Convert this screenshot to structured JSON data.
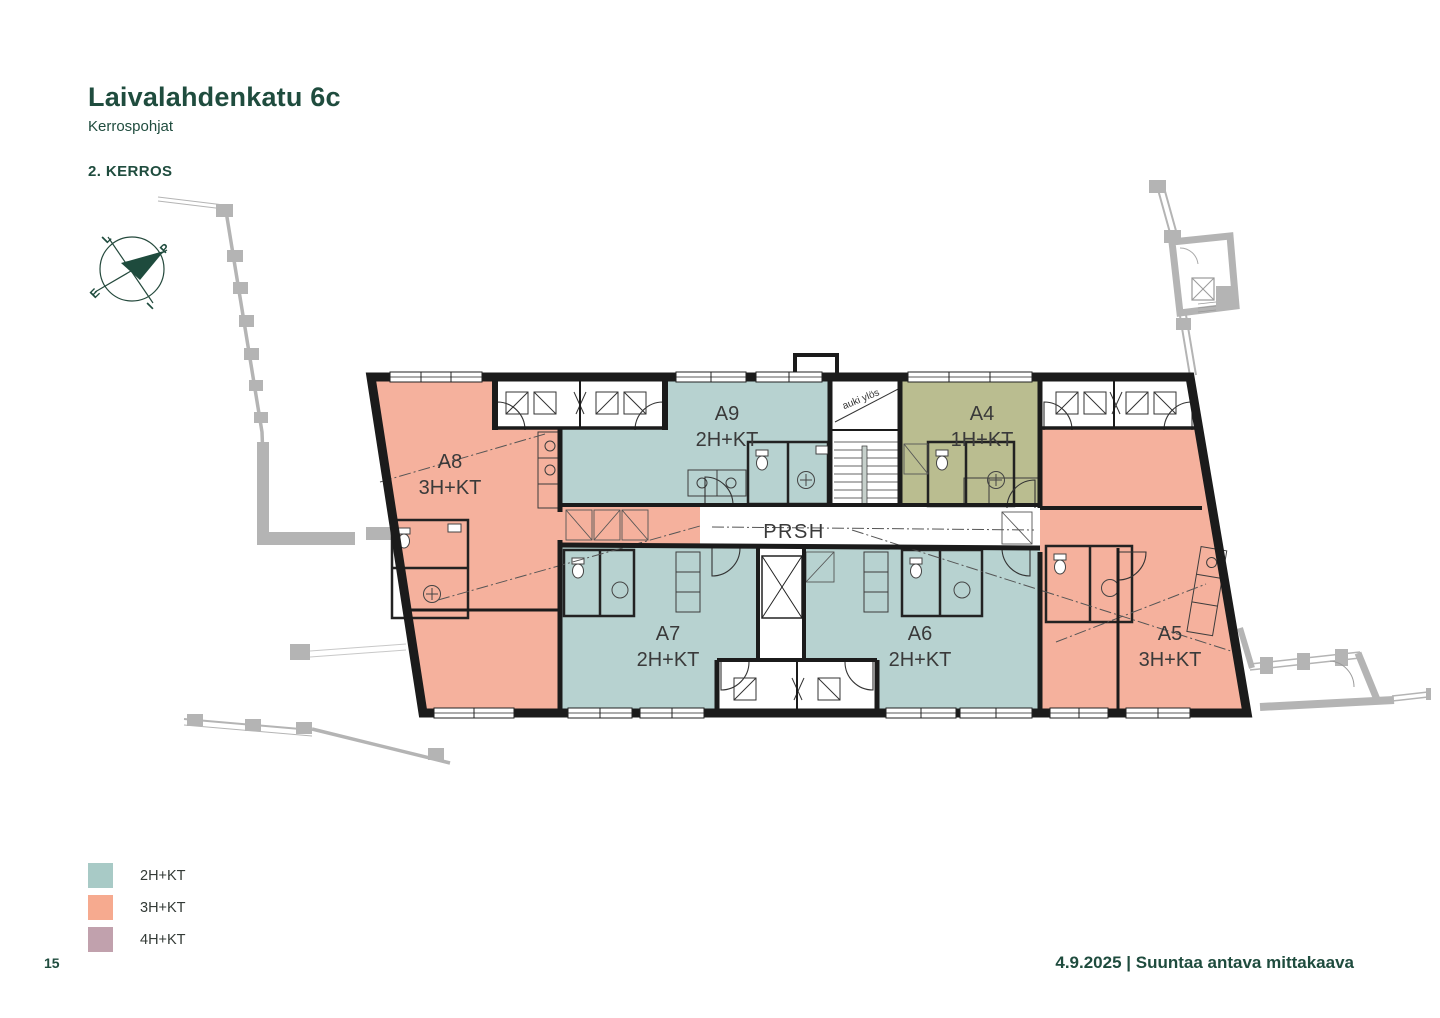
{
  "page": {
    "title": "Laivalahdenkatu 6c",
    "subtitle": "Kerrospohjat",
    "floor_label": "2. KERROS",
    "page_number": "15",
    "footer_text": "4.9.2025 | Suuntaa antava mittakaava"
  },
  "compass": {
    "north": "P",
    "south": "E",
    "east": "I",
    "west": "L",
    "needle_color": "#1e4b3d"
  },
  "legend": [
    {
      "label": "2H+KT",
      "color": "#a8cac6"
    },
    {
      "label": "3H+KT",
      "color": "#f6aa8f"
    },
    {
      "label": "4H+KT",
      "color": "#c1a1ad"
    }
  ],
  "plan": {
    "corridor_label": "PRSH",
    "stair_label": "auki ylös",
    "apartments": [
      {
        "id": "A8",
        "type": "3H+KT",
        "color": "#f5b19d"
      },
      {
        "id": "A9",
        "type": "2H+KT",
        "color": "#b7d2d0"
      },
      {
        "id": "A4",
        "type": "1H+KT",
        "color": "#babd90"
      },
      {
        "id": "A5",
        "type": "3H+KT",
        "color": "#f5b19d"
      },
      {
        "id": "A7",
        "type": "2H+KT",
        "color": "#b7d2d0"
      },
      {
        "id": "A6",
        "type": "2H+KT",
        "color": "#b7d2d0"
      }
    ]
  },
  "colors": {
    "heading": "#1f4c3e",
    "wall": "#1b1b1b",
    "adjacent": "#b4b4b4",
    "label_text": "#3a3a3a"
  }
}
